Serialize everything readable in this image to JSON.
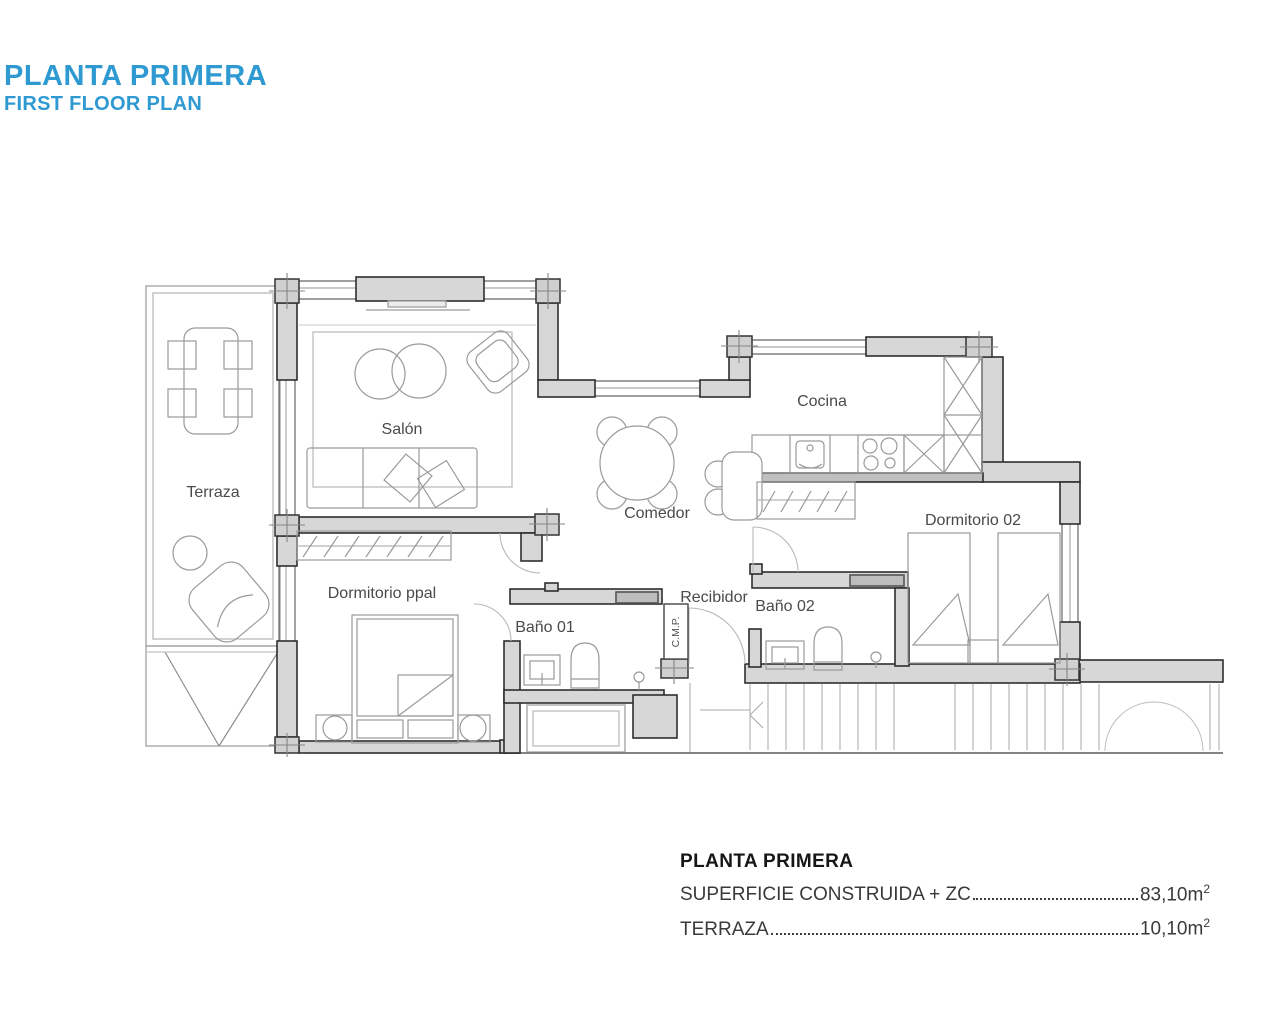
{
  "header": {
    "title": "PLANTA PRIMERA",
    "subtitle": "FIRST FLOOR PLAN",
    "accent": "#2f9ad2"
  },
  "plan": {
    "rooms": {
      "terraza": "Terraza",
      "salon": "Salón",
      "cocina": "Cocina",
      "comedor": "Comedor",
      "dorm_ppal": "Dormitorio ppal",
      "bano01": "Baño 01",
      "recibidor": "Recibidor",
      "bano02": "Baño 02",
      "dorm02": "Dormitorio 02",
      "cmp": "C.M.P."
    },
    "colors": {
      "wall_fill": "#d7d7d7",
      "wall_stroke": "#2e2e2e",
      "furniture_line": "#9a9a9a",
      "label_text": "#4a4a4a"
    }
  },
  "summary": {
    "title": "PLANTA PRIMERA",
    "rows": [
      {
        "label": "SUPERFICIE CONSTRUIDA + ZC",
        "value": "83,10m",
        "sup": "2"
      },
      {
        "label": "TERRAZA",
        "value": "10,10m",
        "sup": "2"
      }
    ]
  }
}
